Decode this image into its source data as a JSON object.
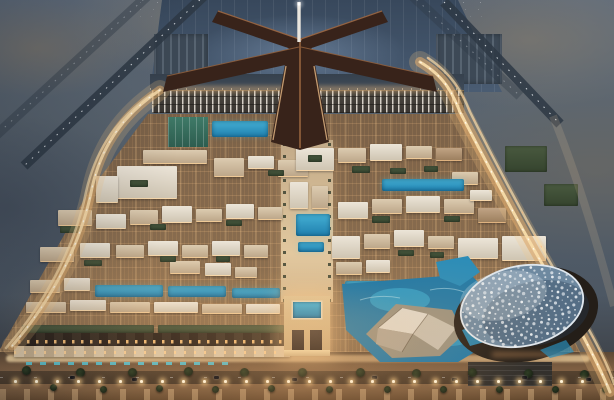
{
  "meta": {
    "description": "Aerial dusk rendering of a desert airport-city masterplan: a falcon-shaped terminal with central spire at top, runways in blue desert, a dense warmly lit low-rise city grid with green roofs and pools, a grand illuminated gateway on the central axis, a white perforated dome arena with blue pools at lower right, an angular white cultural building on water, lit perimeter highways on both sides, and a palm-lined boulevard across the bottom.",
    "type": "architectural-aerial-rendering",
    "time_of_day": "dusk"
  },
  "palette": {
    "desert": "#57626f",
    "desert_tan": "#8a7c68",
    "apron": "#42546a",
    "runway": "#2e3945",
    "runway_dash": "#eef2f6",
    "terminal": "#38231a",
    "terminal_edge": "#9c6743",
    "terminal_ridge": "#a06a42",
    "spire": "#eae6de",
    "glow_warm": "#e8b478",
    "road_core": "#f8dcaa",
    "road_mid": "#dca96c",
    "road_soft": "rgba(244,200,130,0.21)",
    "water_deep": "#1f78a6",
    "water_light": "#39a9cf",
    "pool": "#2e96c0",
    "dome_shell": "#6e89a0",
    "dome_dot": "#f4f7fa",
    "dome_rim": "#dfe7ee",
    "dome_plinth": "#241e18",
    "origami_light": "#ded8cc",
    "origami_mid": "#c6bfb0",
    "origami_dark": "#afa595",
    "building_white": "#e4ddd0",
    "building_cream": "#d7cab6",
    "green_roof": "#3d4f38",
    "window_glow": "#ffca82",
    "street_glow": "#f2cf9a",
    "palm": "#232f1d"
  },
  "scene": {
    "runways": [
      {
        "x1": 206,
        "y1": -6,
        "x2": 24,
        "y2": 166,
        "opacity": 0.85
      },
      {
        "x1": 156,
        "y1": -12,
        "x2": -20,
        "y2": 150,
        "opacity": 0.4
      },
      {
        "x1": 444,
        "y1": 2,
        "x2": 560,
        "y2": 124,
        "opacity": 0.85
      },
      {
        "x1": 404,
        "y1": -12,
        "x2": 520,
        "y2": 96,
        "opacity": 0.35
      }
    ],
    "blocks": [
      [
        117,
        166,
        60,
        32,
        "white"
      ],
      [
        143,
        150,
        64,
        13,
        "cream"
      ],
      [
        214,
        158,
        30,
        18,
        "cream"
      ],
      [
        248,
        156,
        26,
        12,
        "white"
      ],
      [
        278,
        160,
        30,
        16,
        "cream"
      ],
      [
        296,
        148,
        38,
        22,
        "white"
      ],
      [
        338,
        148,
        28,
        14,
        "cream"
      ],
      [
        370,
        144,
        32,
        16,
        "white"
      ],
      [
        406,
        146,
        26,
        12,
        "cream"
      ],
      [
        436,
        148,
        26,
        12,
        "tan"
      ],
      [
        96,
        176,
        22,
        26,
        "white"
      ],
      [
        58,
        210,
        34,
        15,
        "cream"
      ],
      [
        96,
        214,
        30,
        14,
        "white"
      ],
      [
        130,
        210,
        28,
        14,
        "cream"
      ],
      [
        162,
        206,
        30,
        16,
        "white"
      ],
      [
        196,
        209,
        26,
        12,
        "cream"
      ],
      [
        226,
        204,
        28,
        14,
        "white"
      ],
      [
        258,
        207,
        24,
        12,
        "cream"
      ],
      [
        290,
        182,
        18,
        26,
        "white"
      ],
      [
        312,
        186,
        16,
        22,
        "cream"
      ],
      [
        338,
        202,
        30,
        16,
        "white"
      ],
      [
        372,
        199,
        30,
        14,
        "cream"
      ],
      [
        406,
        196,
        34,
        16,
        "white"
      ],
      [
        444,
        199,
        30,
        14,
        "cream"
      ],
      [
        452,
        172,
        26,
        12,
        "cream"
      ],
      [
        470,
        190,
        22,
        10,
        "white"
      ],
      [
        478,
        208,
        28,
        14,
        "tan"
      ],
      [
        40,
        247,
        34,
        14,
        "cream"
      ],
      [
        80,
        243,
        30,
        14,
        "white"
      ],
      [
        116,
        245,
        28,
        12,
        "cream"
      ],
      [
        148,
        241,
        30,
        14,
        "white"
      ],
      [
        182,
        245,
        26,
        12,
        "cream"
      ],
      [
        212,
        241,
        28,
        14,
        "white"
      ],
      [
        244,
        245,
        24,
        12,
        "cream"
      ],
      [
        332,
        236,
        28,
        22,
        "white"
      ],
      [
        364,
        234,
        26,
        14,
        "cream"
      ],
      [
        394,
        230,
        30,
        16,
        "white"
      ],
      [
        428,
        236,
        26,
        12,
        "cream"
      ],
      [
        458,
        238,
        40,
        20,
        "white"
      ],
      [
        502,
        236,
        44,
        24,
        "white"
      ],
      [
        30,
        280,
        30,
        12,
        "cream"
      ],
      [
        64,
        278,
        26,
        12,
        "white"
      ],
      [
        170,
        261,
        30,
        12,
        "cream"
      ],
      [
        205,
        263,
        26,
        12,
        "white"
      ],
      [
        235,
        267,
        22,
        10,
        "cream"
      ],
      [
        336,
        262,
        26,
        12,
        "cream"
      ],
      [
        366,
        260,
        24,
        12,
        "white"
      ],
      [
        26,
        302,
        40,
        10,
        "cream"
      ],
      [
        70,
        300,
        36,
        10,
        "white"
      ],
      [
        110,
        302,
        40,
        10,
        "cream"
      ],
      [
        154,
        302,
        44,
        10,
        "white"
      ],
      [
        202,
        304,
        40,
        9,
        "cream"
      ],
      [
        246,
        304,
        34,
        9,
        "white"
      ]
    ],
    "greens": [
      [
        130,
        180,
        18,
        7
      ],
      [
        308,
        155,
        14,
        7
      ],
      [
        268,
        170,
        16,
        6
      ],
      [
        352,
        166,
        18,
        7
      ],
      [
        390,
        168,
        16,
        6
      ],
      [
        424,
        166,
        14,
        6
      ],
      [
        60,
        226,
        20,
        7
      ],
      [
        150,
        224,
        16,
        6
      ],
      [
        226,
        220,
        16,
        6
      ],
      [
        372,
        216,
        18,
        7
      ],
      [
        444,
        216,
        16,
        6
      ],
      [
        84,
        260,
        18,
        6
      ],
      [
        160,
        256,
        16,
        6
      ],
      [
        216,
        256,
        14,
        6
      ],
      [
        398,
        250,
        16,
        6
      ],
      [
        430,
        252,
        14,
        6
      ],
      [
        505,
        146,
        42,
        26
      ],
      [
        544,
        184,
        34,
        22
      ],
      [
        22,
        325,
        132,
        8
      ],
      [
        158,
        325,
        126,
        8
      ]
    ],
    "courts": [
      [
        168,
        117,
        40,
        30
      ]
    ],
    "pools": [
      [
        212,
        121,
        56,
        16
      ],
      [
        382,
        179,
        82,
        12
      ],
      [
        296,
        214,
        34,
        22
      ],
      [
        298,
        242,
        26,
        10
      ],
      [
        95,
        285,
        68,
        12
      ],
      [
        168,
        286,
        58,
        11
      ],
      [
        232,
        288,
        48,
        10
      ],
      [
        345,
        281,
        36,
        13
      ]
    ],
    "strips": [
      [
        18,
        333,
        268,
        13,
        "houses-dark"
      ],
      [
        14,
        346,
        276,
        11,
        "houses-light"
      ],
      [
        468,
        362,
        84,
        24,
        "lot-dark"
      ]
    ],
    "palms": [
      [
        22,
        366
      ],
      [
        50,
        384
      ],
      [
        76,
        368
      ],
      [
        100,
        386
      ],
      [
        128,
        368
      ],
      [
        156,
        385
      ],
      [
        184,
        367
      ],
      [
        212,
        386
      ],
      [
        240,
        368
      ],
      [
        268,
        385
      ],
      [
        298,
        368
      ],
      [
        326,
        386
      ],
      [
        356,
        368
      ],
      [
        384,
        386
      ],
      [
        412,
        369
      ],
      [
        440,
        386
      ],
      [
        468,
        368
      ],
      [
        496,
        386
      ],
      [
        524,
        369
      ],
      [
        552,
        386
      ],
      [
        580,
        370
      ],
      [
        602,
        386
      ]
    ],
    "cars": [
      [
        70,
        376
      ],
      [
        132,
        378
      ],
      [
        214,
        376
      ],
      [
        292,
        378
      ],
      [
        372,
        376
      ],
      [
        452,
        378
      ],
      [
        522,
        376
      ],
      [
        586,
        378
      ]
    ],
    "promenade_lights": {
      "y": 380,
      "x0": 14,
      "dx": 21,
      "count": 28
    },
    "dome": {
      "cx": 522,
      "cy": 306,
      "rx": 62,
      "ry": 40,
      "rot": -12,
      "dots": 240
    }
  }
}
